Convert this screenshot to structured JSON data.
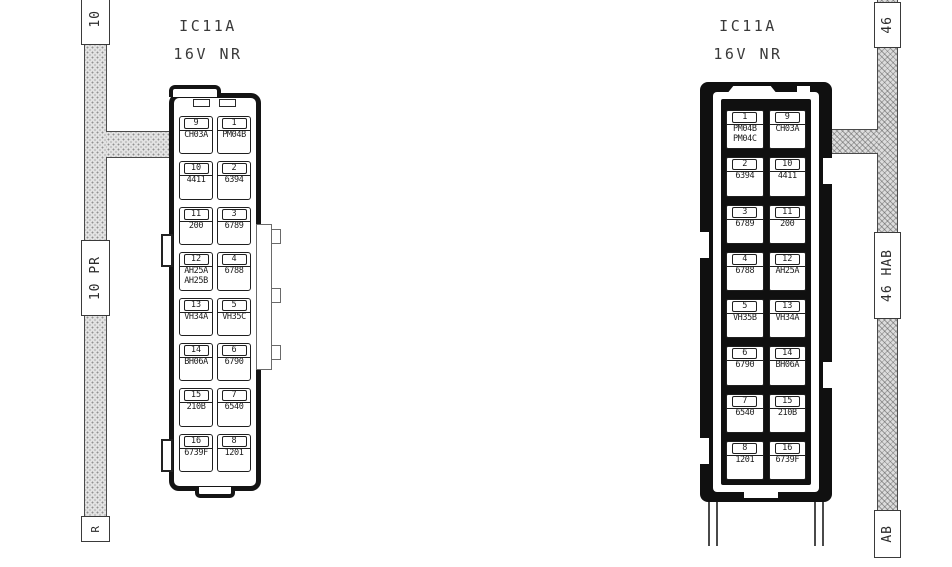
{
  "diagram": {
    "kind": "connector-pinout-wiring-diagram",
    "colors": {
      "paper": "#ffffff",
      "line": "#1f1f1f",
      "frame_fill": "#101010",
      "hatch_base": "#e2e2e2",
      "hatch_dot": "#8f8f8f"
    },
    "views": {
      "left": {
        "title": [
          "IC11A",
          "16V NR"
        ],
        "bus_labels": {
          "top": "10",
          "middle": "10 PR",
          "bottom": "R"
        },
        "rows": [
          [
            {
              "n": "9",
              "l": "CH03A"
            },
            {
              "n": "1",
              "l": "PM04B"
            }
          ],
          [
            {
              "n": "10",
              "l": "4411"
            },
            {
              "n": "2",
              "l": "6394"
            }
          ],
          [
            {
              "n": "11",
              "l": "200"
            },
            {
              "n": "3",
              "l": "6789"
            }
          ],
          [
            {
              "n": "12",
              "l": "AH25A\nAH25B"
            },
            {
              "n": "4",
              "l": "6788"
            }
          ],
          [
            {
              "n": "13",
              "l": "VH34A"
            },
            {
              "n": "5",
              "l": "VH35C"
            }
          ],
          [
            {
              "n": "14",
              "l": "BH06A"
            },
            {
              "n": "6",
              "l": "6790"
            }
          ],
          [
            {
              "n": "15",
              "l": "210B"
            },
            {
              "n": "7",
              "l": "6540"
            }
          ],
          [
            {
              "n": "16",
              "l": "6739F"
            },
            {
              "n": "8",
              "l": "1201"
            }
          ]
        ]
      },
      "right": {
        "title": [
          "IC11A",
          "16V NR"
        ],
        "bus_labels": {
          "top": "46",
          "middle": "46 HAB",
          "bottom": "AB"
        },
        "rows": [
          [
            {
              "n": "1",
              "l": "PM04B\nPM04C"
            },
            {
              "n": "9",
              "l": "CH03A"
            }
          ],
          [
            {
              "n": "2",
              "l": "6394"
            },
            {
              "n": "10",
              "l": "4411"
            }
          ],
          [
            {
              "n": "3",
              "l": "6789"
            },
            {
              "n": "11",
              "l": "200"
            }
          ],
          [
            {
              "n": "4",
              "l": "6788"
            },
            {
              "n": "12",
              "l": "AH25A"
            }
          ],
          [
            {
              "n": "5",
              "l": "VH35B"
            },
            {
              "n": "13",
              "l": "VH34A"
            }
          ],
          [
            {
              "n": "6",
              "l": "6790"
            },
            {
              "n": "14",
              "l": "BH06A"
            }
          ],
          [
            {
              "n": "7",
              "l": "6540"
            },
            {
              "n": "15",
              "l": "210B"
            }
          ],
          [
            {
              "n": "8",
              "l": "1201"
            },
            {
              "n": "16",
              "l": "6739F"
            }
          ]
        ]
      }
    }
  }
}
